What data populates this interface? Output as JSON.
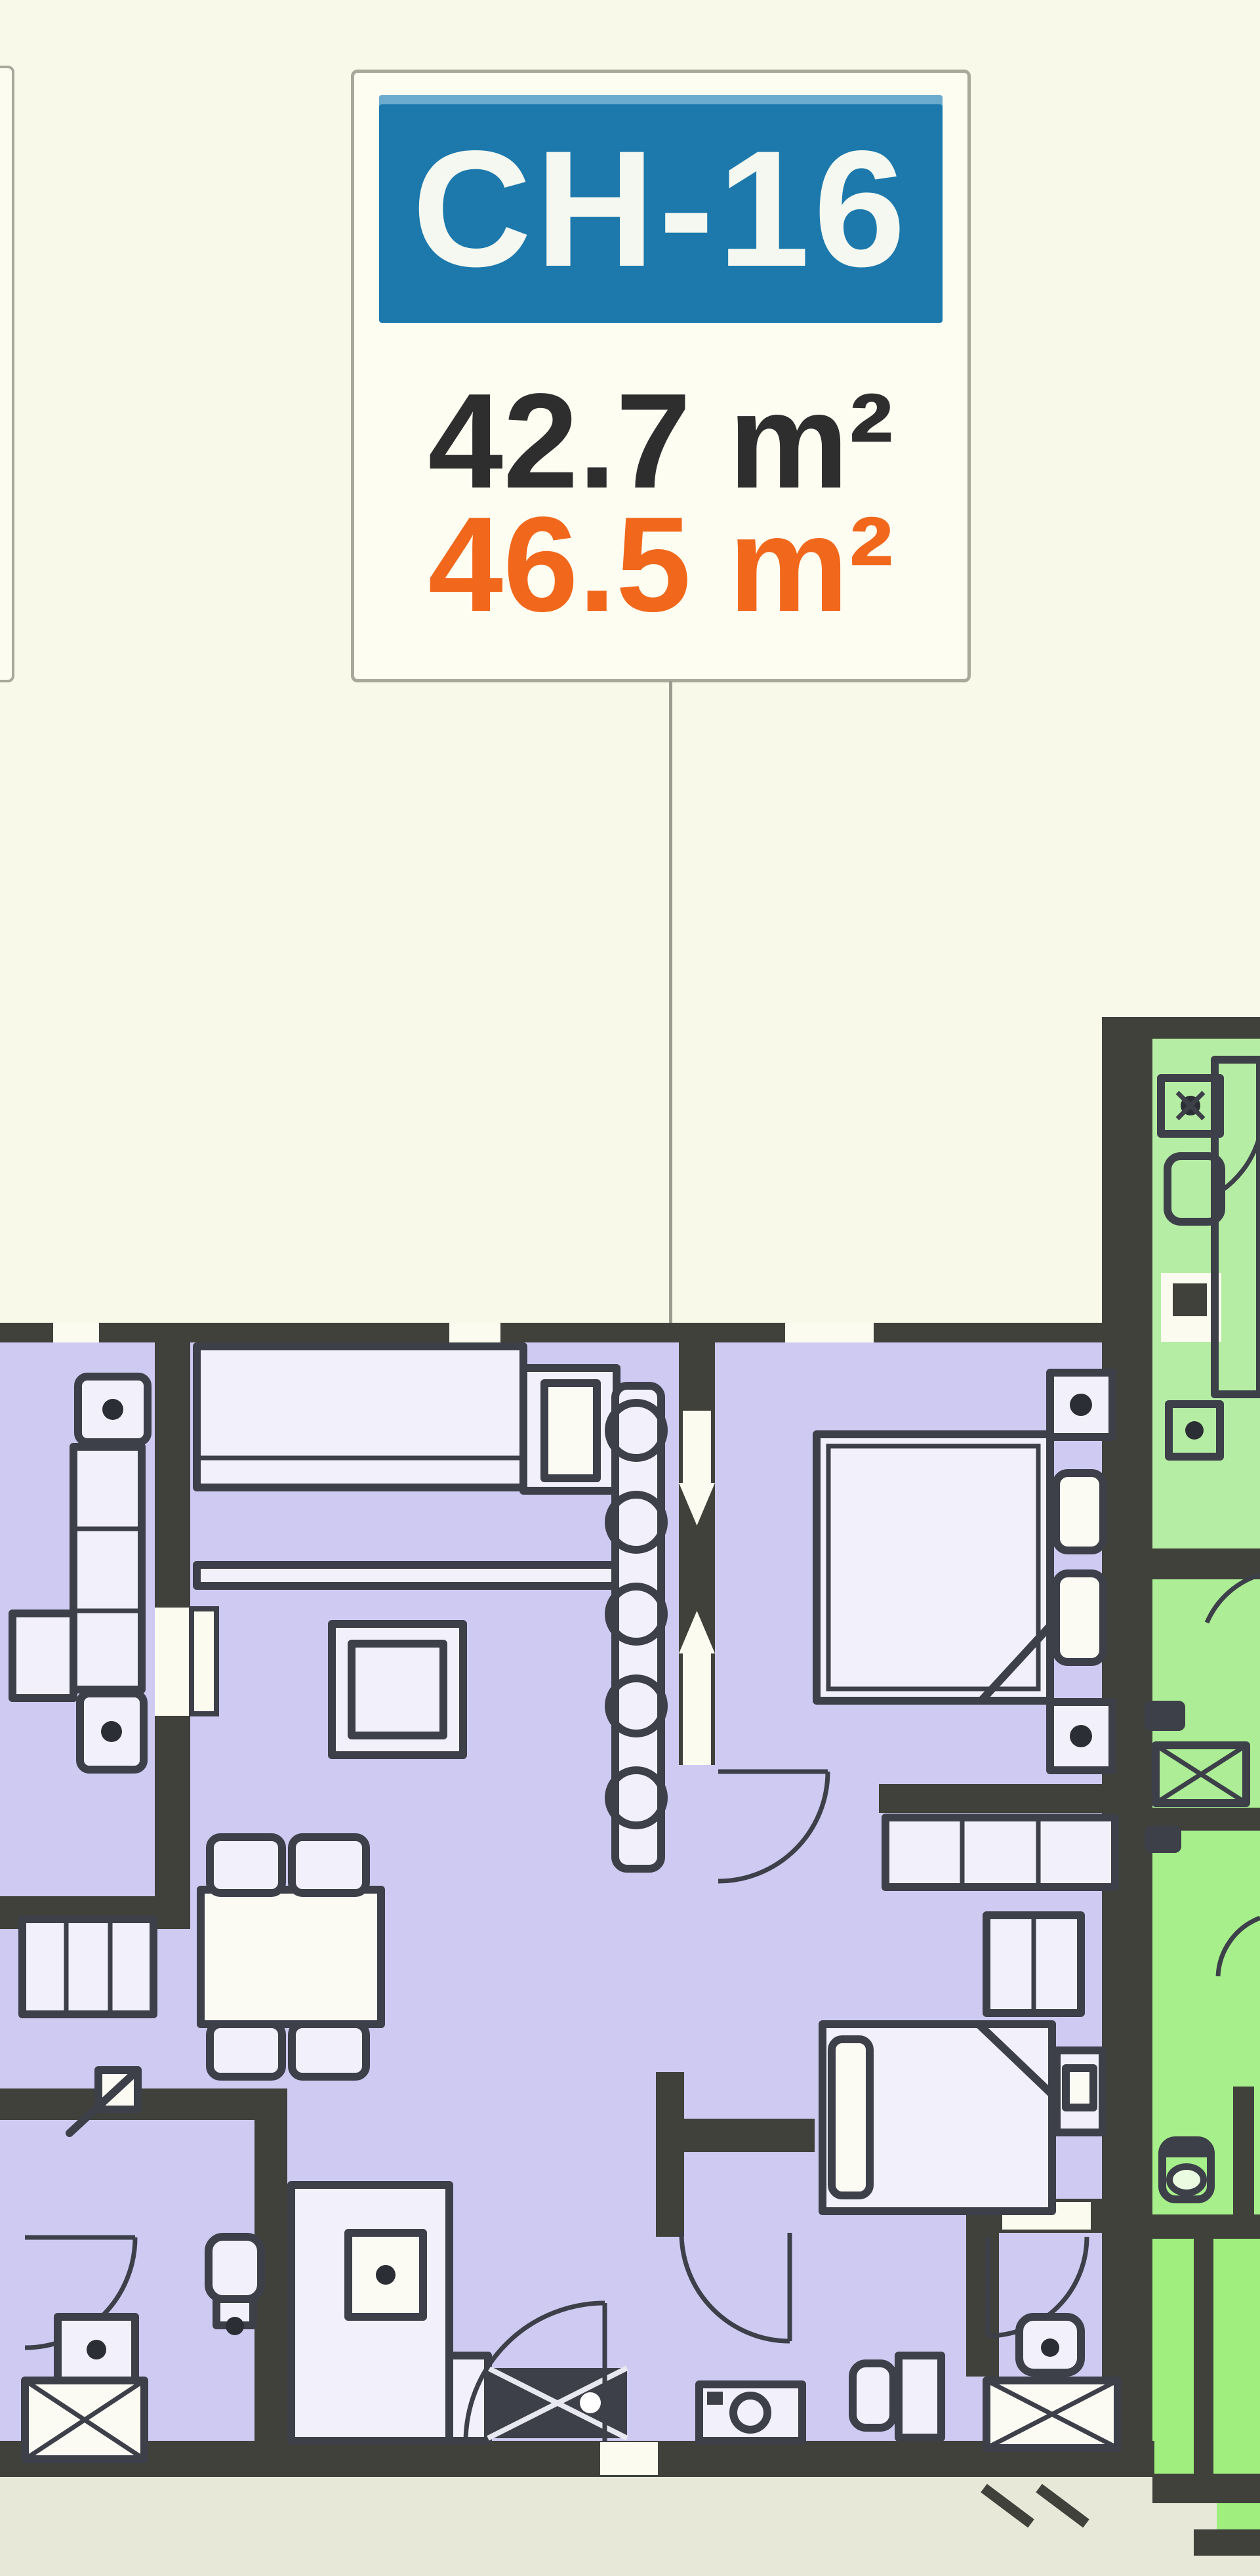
{
  "page": {
    "background_color": "#f8f9e9",
    "lower_band_color": "#e7e8d8"
  },
  "unit_card": {
    "code": "CH-16",
    "area_primary": "42.7 m²",
    "area_secondary": "46.5 m²",
    "header_bg_color": "#1d79ac",
    "header_text_color": "#f4f8f0",
    "area_primary_color": "#2e2e2e",
    "area_secondary_color": "#f1681c",
    "card_bg_color": "#fdfdf2",
    "card_border_color": "#a9a99b"
  },
  "leader_line": {
    "color": "#9c9c90"
  },
  "floor_plan": {
    "selected_unit_fill": "#cfcaf2",
    "neighbor_unit_fill_top": "#b6eda4",
    "neighbor_unit_fill_bottom": "#9fee7e",
    "wall_color": "#3f413a",
    "furniture_line_color": "#3d3f49",
    "rooms_selected_unit": [
      "living-dining",
      "kitchen",
      "bedroom-1",
      "bedroom-2",
      "bathroom-1",
      "bathroom-2",
      "lounge-strip"
    ],
    "rooms_neighbor_unit": [
      "bedroom",
      "bathroom",
      "hall",
      "wc",
      "corridor"
    ]
  }
}
